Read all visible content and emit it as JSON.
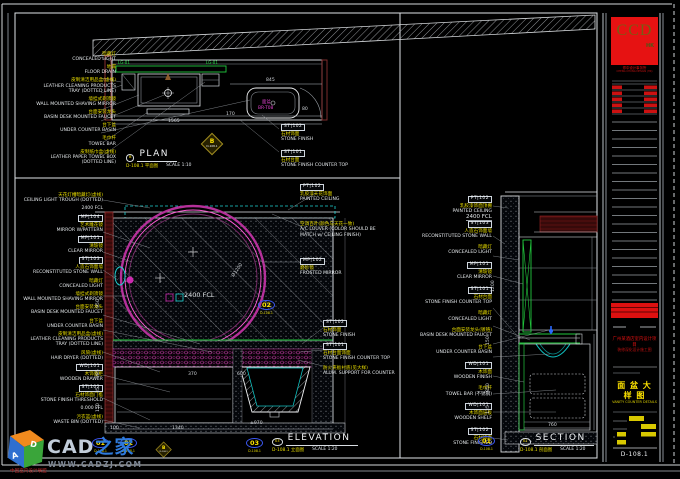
{
  "sheet": {
    "number": "D-108.1"
  },
  "plan": {
    "title": "PLAN",
    "title_marker": "B",
    "title_ref": "D-108.1 平面图",
    "title_scale": "SCALE 1:10",
    "detail_marker": {
      "letter": "B",
      "ref": "D-108.1"
    },
    "labels_left": [
      {
        "cn": "暗藏灯",
        "en": "CONCEALED LIGHT"
      },
      {
        "cn": "地漏",
        "en": "FLOOR DRAIN"
      },
      {
        "cn": "皮制清洁用品盒(虚线)",
        "en": "LEATHER CLEANING PRODUCTS",
        "en2": "TRAY (DOTTED LINE)"
      },
      {
        "cn": "墙挂式剃须镜",
        "en": "WALL MOUNTED SHAVING MIRROR"
      },
      {
        "cn": "台面安装龙头",
        "en": "BASIN DESK MOUNTED FAUCET"
      },
      {
        "cn": "台下盆",
        "en": "UNDER COUNTER BASIN"
      },
      {
        "cn": "毛巾杆",
        "en": "TOWEL BAR"
      },
      {
        "cn": "皮制纸巾盒(虚线)",
        "en": "LEATHER PAPER TOWEL BOX",
        "en2": "(DOTTED LINE)"
      }
    ],
    "labels_right": [
      {
        "code": "ST|102",
        "cn": "石材饰面",
        "en": "STONE FINISH"
      },
      {
        "code": "ST|101",
        "cn": "石材台面",
        "en": "STONE FINISH COUNTER TOP"
      }
    ],
    "green_tag_left": "LG-01",
    "green_tag_right": "LG-01",
    "fixture_cn": "面盆",
    "fixture_code": "BR-T08",
    "dims": {
      "d845": "845",
      "d80": "80",
      "d170": "170",
      "d1565": "1565"
    }
  },
  "elevation": {
    "title": "ELEVATION",
    "title_marker": "03",
    "title_ref": "D-108.1 立面图",
    "title_scale": "SCALE 1:20",
    "labels_left": [
      {
        "cn": "天花灯槽暗藏灯(虚线)",
        "en": "CEILING LIGHT TROUGH (DOTTED)"
      },
      {
        "en": "2400 FCL"
      },
      {
        "code": "MP|104",
        "cn": "艺术雕花镜",
        "en": "MIRROR W/PATTERN"
      },
      {
        "code": "MP|101",
        "cn": "清玻镜",
        "en": "CLEAR MIRROR"
      },
      {
        "code": "ST|103",
        "cn": "人造石饰面墙",
        "en": "RECONSTITUTED STONE WALL"
      },
      {
        "cn": "暗藏灯",
        "en": "CONCEALED LIGHT"
      },
      {
        "cn": "墙挂式剃须镜",
        "en": "WALL MOUNTED SHAVING MIRROR"
      },
      {
        "cn": "台面安装龙头",
        "en": "BASIN DESK MOUNTED FAUCET"
      },
      {
        "cn": "台下盆",
        "en": "UNDER COUNTER BASIN"
      },
      {
        "cn": "皮制清洁用品盒(虚线)",
        "en": "LEATHER CLEANING PRODUCTS",
        "en2": "TRAY (DOTTED LINE)"
      },
      {
        "cn": "风筒(虚线)",
        "en": "HAIR DRYER (DOTTED)"
      },
      {
        "code": "WD|101",
        "cn": "木饰面柜",
        "en": "WOODEN DRAWER"
      },
      {
        "code": "ST|102",
        "cn": "石材饰面门槛",
        "en": "STONE FINISH THRESHOLD"
      },
      {
        "en": "0.000 FFL"
      },
      {
        "cn": "污衣篮(虚线)",
        "en": "WASTE BIN (DOTTED)"
      }
    ],
    "labels_right_top": [
      {
        "code": "PT|102",
        "cn": "乳胶漆天花饰面",
        "en": "PAINTED CEILING"
      },
      {
        "cn": "空调百叶(颜色与天花一致)",
        "en": "A/C LOUVER (COLOR SHOULD BE",
        "en2": "MATCH w/ CEILING FINISH)"
      },
      {
        "code": "MP|102",
        "cn": "磨砂镜",
        "en": "FROSTED MIRROR"
      }
    ],
    "labels_right_mid": [
      {
        "code": "ST|102",
        "cn": "石材饰面",
        "en": "STONE FINISH"
      },
      {
        "code": "ST|101",
        "cn": "石材台面饰面",
        "en": "STONE FINISH COUNTER TOP"
      },
      {
        "cn": "防火夹板衬底(见大样)",
        "en": "ALUM. SUPPORT FOR COUNTER"
      }
    ],
    "mirror_fcl": "2400 FCL",
    "mirror_dia": "Ø1200",
    "marker_mirror": {
      "num": "02",
      "ref": "D-108.1"
    },
    "marker_01": {
      "num": "01",
      "ref": "D-108.1"
    },
    "marker_02": {
      "num": "02",
      "ref": "D-108.1"
    },
    "marker_03": {
      "num": "03",
      "ref": "D-108.1"
    },
    "detail_marker": {
      "letter": "B",
      "ref": "D-108.1"
    },
    "dims": {
      "d370": "370",
      "d600": "600",
      "d100": "100",
      "d1340": "1340",
      "d970": "±970",
      "v950": "950",
      "v285": "285",
      "v35": "35",
      "v150": "150"
    }
  },
  "section": {
    "title": "SECTION",
    "title_marker": "01",
    "title_ref": "D-108.1 剖面图",
    "title_scale": "SCALE 1:20",
    "fcl": "2400 FCL",
    "marker_01": {
      "num": "01",
      "ref": "D-108.1"
    },
    "labels_left": [
      {
        "code": "PT|102",
        "cn": "乳胶漆饰面顶棚",
        "en": "PAINTED CEILING"
      },
      {
        "code": "ST|103",
        "cn": "人造石饰面墙",
        "en": "RECONSTITUTED STONE WALL"
      },
      {
        "cn": "暗藏灯",
        "en": "CONCEALED LIGHT"
      },
      {
        "code": "MP|101",
        "cn": "清玻镜",
        "en": "CLEAR MIRROR"
      },
      {
        "code": "ST|101",
        "cn": "石材台面",
        "en": "STONE FINISH COUNTER TOP"
      },
      {
        "cn": "暗藏灯",
        "en": "CONCEALED LIGHT"
      },
      {
        "cn": "台面安装龙头(镀铬)",
        "en": "BASIN DESK MOUNTED FAUCET"
      },
      {
        "cn": "台下盆",
        "en": "UNDER COUNTER BASIN"
      },
      {
        "code": "WD|101",
        "cn": "木饰面",
        "en": "WOODEN FINISH"
      },
      {
        "cn": "毛巾杆",
        "en": "TOWEL BAR (不锈钢)"
      },
      {
        "code": "WD|101",
        "cn": "木饰面层板",
        "en": "WOODEN SHELF"
      },
      {
        "code": "ST|102",
        "cn": "石材饰面",
        "en": "STONE FINISHED"
      }
    ],
    "dims": {
      "v1200": "1200",
      "v150": "150",
      "v850": "850",
      "v135": "135",
      "d760": "760"
    }
  },
  "titleblock": {
    "logo": "CCD",
    "logo_sub": "HK",
    "company_cn": "郑中设计事务所",
    "company_en": "CHENG CHUNG DESIGN (HK)",
    "project_line1": "广州某酒店室内设计项目",
    "project_line2": "装修深化设计施工图",
    "sheet_title_cn": "面 盆 大 样 图",
    "sheet_title_en": "VANITY COUNTER DETAILS",
    "sheet_no": "D-108.1"
  },
  "watermark": {
    "brand": "CAD",
    "brand2": "之家",
    "url": "WWW.CADZJ.COM",
    "tagline": "中国室内设计联盟",
    "cube_a": "A",
    "cube_d": "D"
  }
}
